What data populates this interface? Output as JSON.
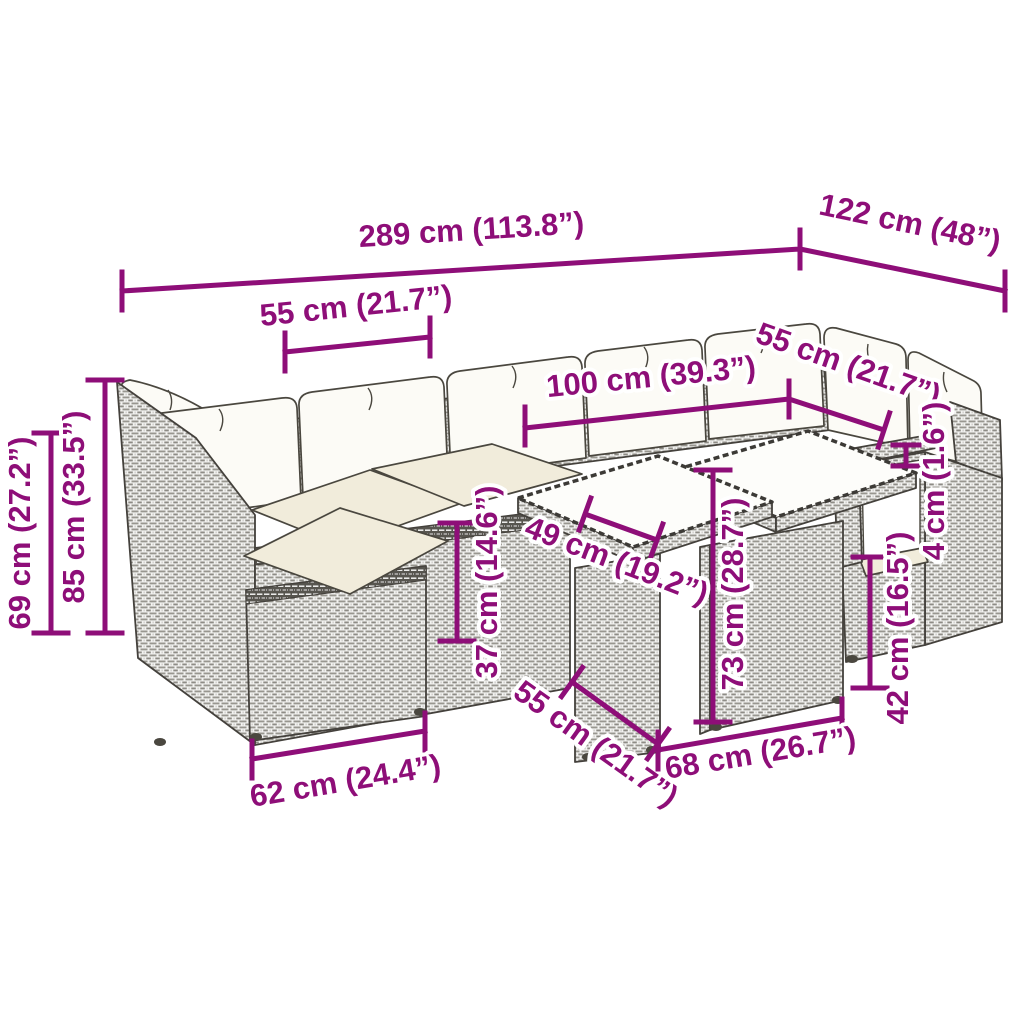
{
  "figure": {
    "kind": "product-dimension-diagram",
    "background_color": "#ffffff",
    "accent_color": "#8E0E78",
    "drawing_line_color": "#44413c",
    "cushion_color": "#f1ecdb"
  },
  "dimensions": [
    {
      "name": "overall-width",
      "value_cm": 289,
      "value_in": 113.8,
      "text": "289 cm (113.8”)"
    },
    {
      "name": "corner-section-width",
      "value_cm": 122,
      "value_in": 48,
      "text": "122 cm (48”)"
    },
    {
      "name": "seat-module-width-top",
      "value_cm": 55,
      "value_in": 21.7,
      "text": "55 cm (21.7”)"
    },
    {
      "name": "table-group-width",
      "value_cm": 100,
      "value_in": 39.3,
      "text": "100 cm (39.3”)"
    },
    {
      "name": "seat-module-width-right",
      "value_cm": 55,
      "value_in": 21.7,
      "text": "55 cm (21.7”)"
    },
    {
      "name": "armrest-side-height",
      "value_cm": 69,
      "value_in": 27.2,
      "text": "69 cm (27.2”)"
    },
    {
      "name": "back-total-height",
      "value_cm": 85,
      "value_in": 33.5,
      "text": "85 cm (33.5”)"
    },
    {
      "name": "seat-height",
      "value_cm": 37,
      "value_in": 14.6,
      "text": "37 cm (14.6”)"
    },
    {
      "name": "table-top-depth",
      "value_cm": 49,
      "value_in": 19.2,
      "text": "49 cm (19.2”)"
    },
    {
      "name": "table-height",
      "value_cm": 73,
      "value_in": 28.7,
      "text": "73 cm (28.7”)"
    },
    {
      "name": "armrest-thickness",
      "value_cm": 4,
      "value_in": 1.6,
      "text": "4 cm (1.6”)"
    },
    {
      "name": "base-height",
      "value_cm": 42,
      "value_in": 16.5,
      "text": "42 cm (16.5”)"
    },
    {
      "name": "stool-width",
      "value_cm": 62,
      "value_in": 24.4,
      "text": "62 cm (24.4”)"
    },
    {
      "name": "stool-depth",
      "value_cm": 55,
      "value_in": 21.7,
      "text": "55 cm (21.7”)"
    },
    {
      "name": "table-base-width",
      "value_cm": 68,
      "value_in": 26.7,
      "text": "68 cm (26.7”)"
    }
  ]
}
